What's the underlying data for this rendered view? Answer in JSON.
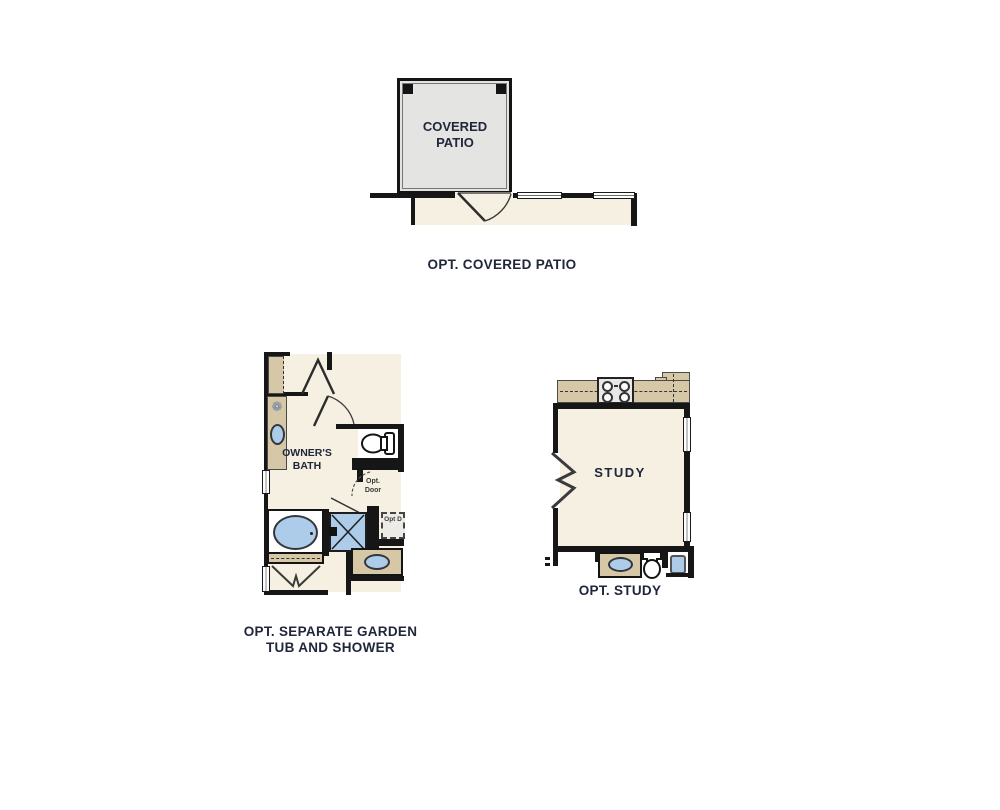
{
  "colors": {
    "wall": "#161616",
    "floor_cream": "#f6f0e2",
    "patio_gray": "#e4e4e2",
    "counter_tan": "#d6c8a7",
    "fixture_blue": "#accce9",
    "text_navy": "#20273a"
  },
  "icons": {
    "flower_decor_glyph": "❁"
  },
  "plans": {
    "covered_patio": {
      "room_label": "COVERED PATIO",
      "caption": "OPT. COVERED PATIO"
    },
    "owners_bath": {
      "room_label": "OWNER'S BATH",
      "opt_door_label": "Opt. Door",
      "opt_d_label": "Opt D",
      "caption": "OPT. SEPARATE GARDEN TUB AND SHOWER"
    },
    "study": {
      "room_label": "STUDY",
      "caption": "OPT. STUDY"
    }
  }
}
